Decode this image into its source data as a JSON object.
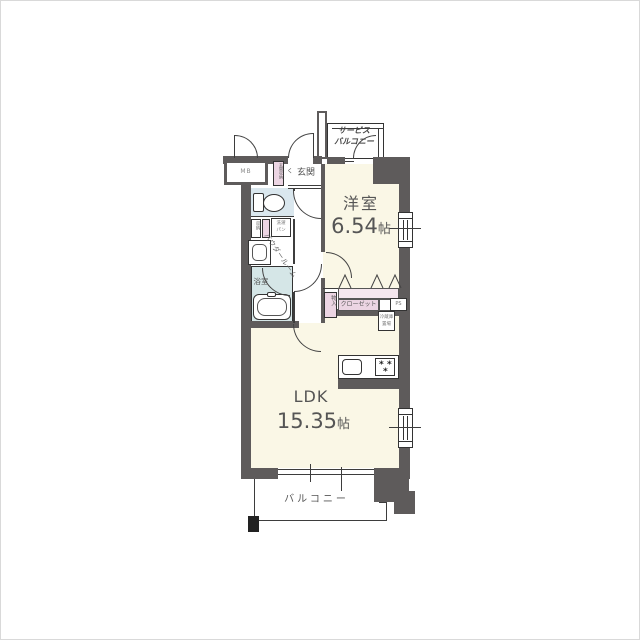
{
  "floorplan": {
    "rooms": {
      "western": {
        "name": "洋室",
        "size_value": "6.54",
        "size_unit": "帖"
      },
      "ldk": {
        "name": "LDK",
        "size_value": "15.35",
        "size_unit": "帖"
      },
      "balcony": {
        "name": "バルコニー"
      },
      "service_balcony": {
        "line1": "サービス",
        "line2": "バルコニー"
      },
      "entrance": {
        "name": "玄関"
      },
      "bathroom": {
        "name": "浴室"
      },
      "powder": {
        "name": "パウダールーム"
      }
    },
    "storage": {
      "closet": "クローゼット",
      "monoire": "物入",
      "shoe_cabinet": "玄関収納",
      "small_cabinet": "収納"
    },
    "fixtures": {
      "laundry_line1": "洗濯",
      "laundry_line2": "パン"
    },
    "utilities": {
      "meter_box": "MB",
      "pipe_space": "PS",
      "fridge_line1": "冷蔵庫",
      "fridge_line2": "置場"
    },
    "marks": {
      "entrance_step": "く"
    },
    "colors": {
      "wall": "#5E5B5B",
      "room_floor": "#FAF7E6",
      "wet_floor": "#DAE7EE",
      "storage_pink": "#ECD5E3",
      "line": "#333333"
    }
  }
}
